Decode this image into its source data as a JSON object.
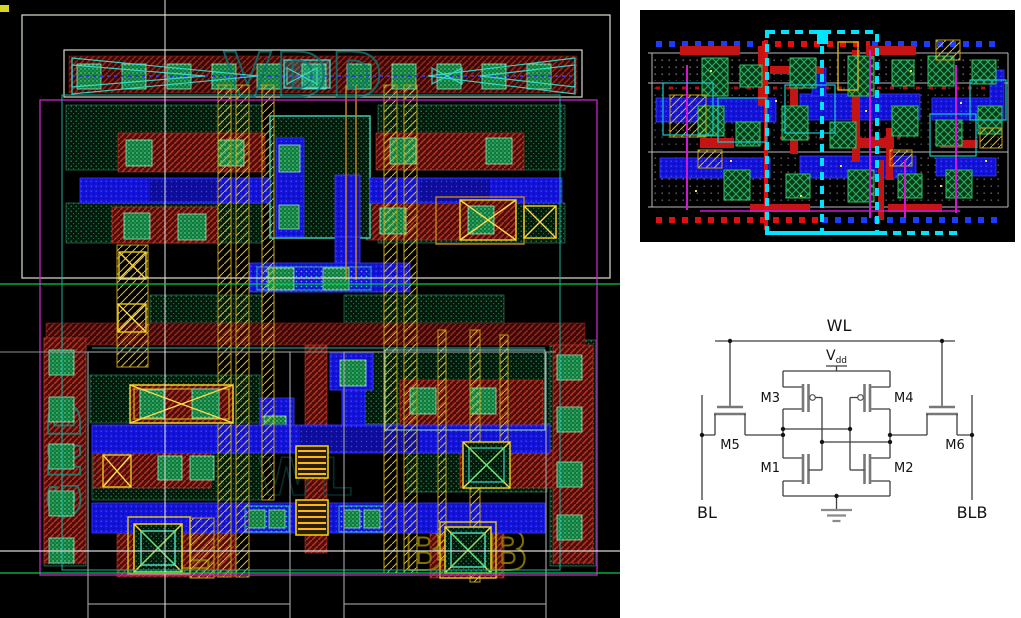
{
  "main_layout": {
    "title": "SRAM 6T cell layout",
    "background": "#000000",
    "labels": {
      "power_rail": "VDD",
      "ground_rail": "GND",
      "wordline": "WL",
      "bitline": "BL",
      "bitline_bar": "BLB"
    },
    "colors": {
      "diffusion_green": "#2a9e58",
      "contact_green": "#7fe0a6",
      "poly_red": "#c03020",
      "metal1_blue": "#1212d8",
      "metal2_yellow": "#d9b422",
      "via_yellow": "#ffd84a",
      "nwell_teal": "#3cc8b4",
      "boundary_white": "#e0e0d0",
      "boundary_magenta": "#c823c8",
      "ruler_green": "#00cc44",
      "label_teal": "#0f7272",
      "label_olive": "#8f7d00"
    }
  },
  "array_layout": {
    "title": "SRAM array layout overview",
    "background": "#000000",
    "selection_color": "#00e5ff"
  },
  "schematic": {
    "title": "6T SRAM cell schematic",
    "background": "#ffffff",
    "labels": {
      "wordline": "WL",
      "supply": "V",
      "supply_sub": "dd",
      "bitline": "BL",
      "bitline_bar": "BLB",
      "m1": "M1",
      "m2": "M2",
      "m3": "M3",
      "m4": "M4",
      "m5": "M5",
      "m6": "M6"
    }
  }
}
